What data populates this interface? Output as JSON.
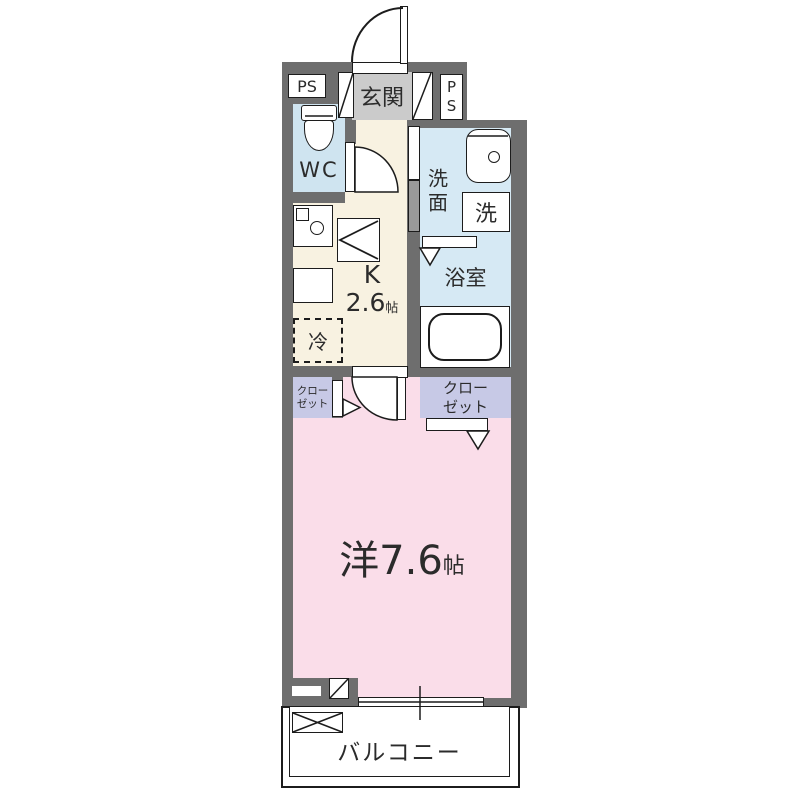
{
  "title": "apartment-floor-plan",
  "colors": {
    "wall": "#6e6e6e",
    "outline": "#1c1c1c",
    "entrance-floor": "#cbcbcb",
    "wc-floor": "#cfe4f0",
    "bath-floor": "#d6e9f4",
    "kitchen-floor": "#f8f2e1",
    "closet-floor": "#c7c9e6",
    "room-floor": "#fadde9",
    "text": "#2b2b2b"
  },
  "rooms": {
    "ps_left": {
      "label": "PS"
    },
    "ps_right": {
      "label": "PS"
    },
    "entrance": {
      "label": "玄関"
    },
    "wc": {
      "label": "WC"
    },
    "washroom": {
      "label": "洗面"
    },
    "laundry": {
      "label": "洗"
    },
    "bathroom": {
      "label": "浴室"
    },
    "kitchen": {
      "letter": "K",
      "size": "2.6",
      "unit": "帖"
    },
    "fridge": {
      "label": "冷"
    },
    "closet_right": {
      "line1": "クロー",
      "line2": "ゼット"
    },
    "closet_left": {
      "line1": "クロー",
      "line2": "ゼット"
    },
    "main_room": {
      "label": "洋7.6",
      "unit": "帖"
    },
    "balcony": {
      "label": "バルコニー"
    }
  }
}
